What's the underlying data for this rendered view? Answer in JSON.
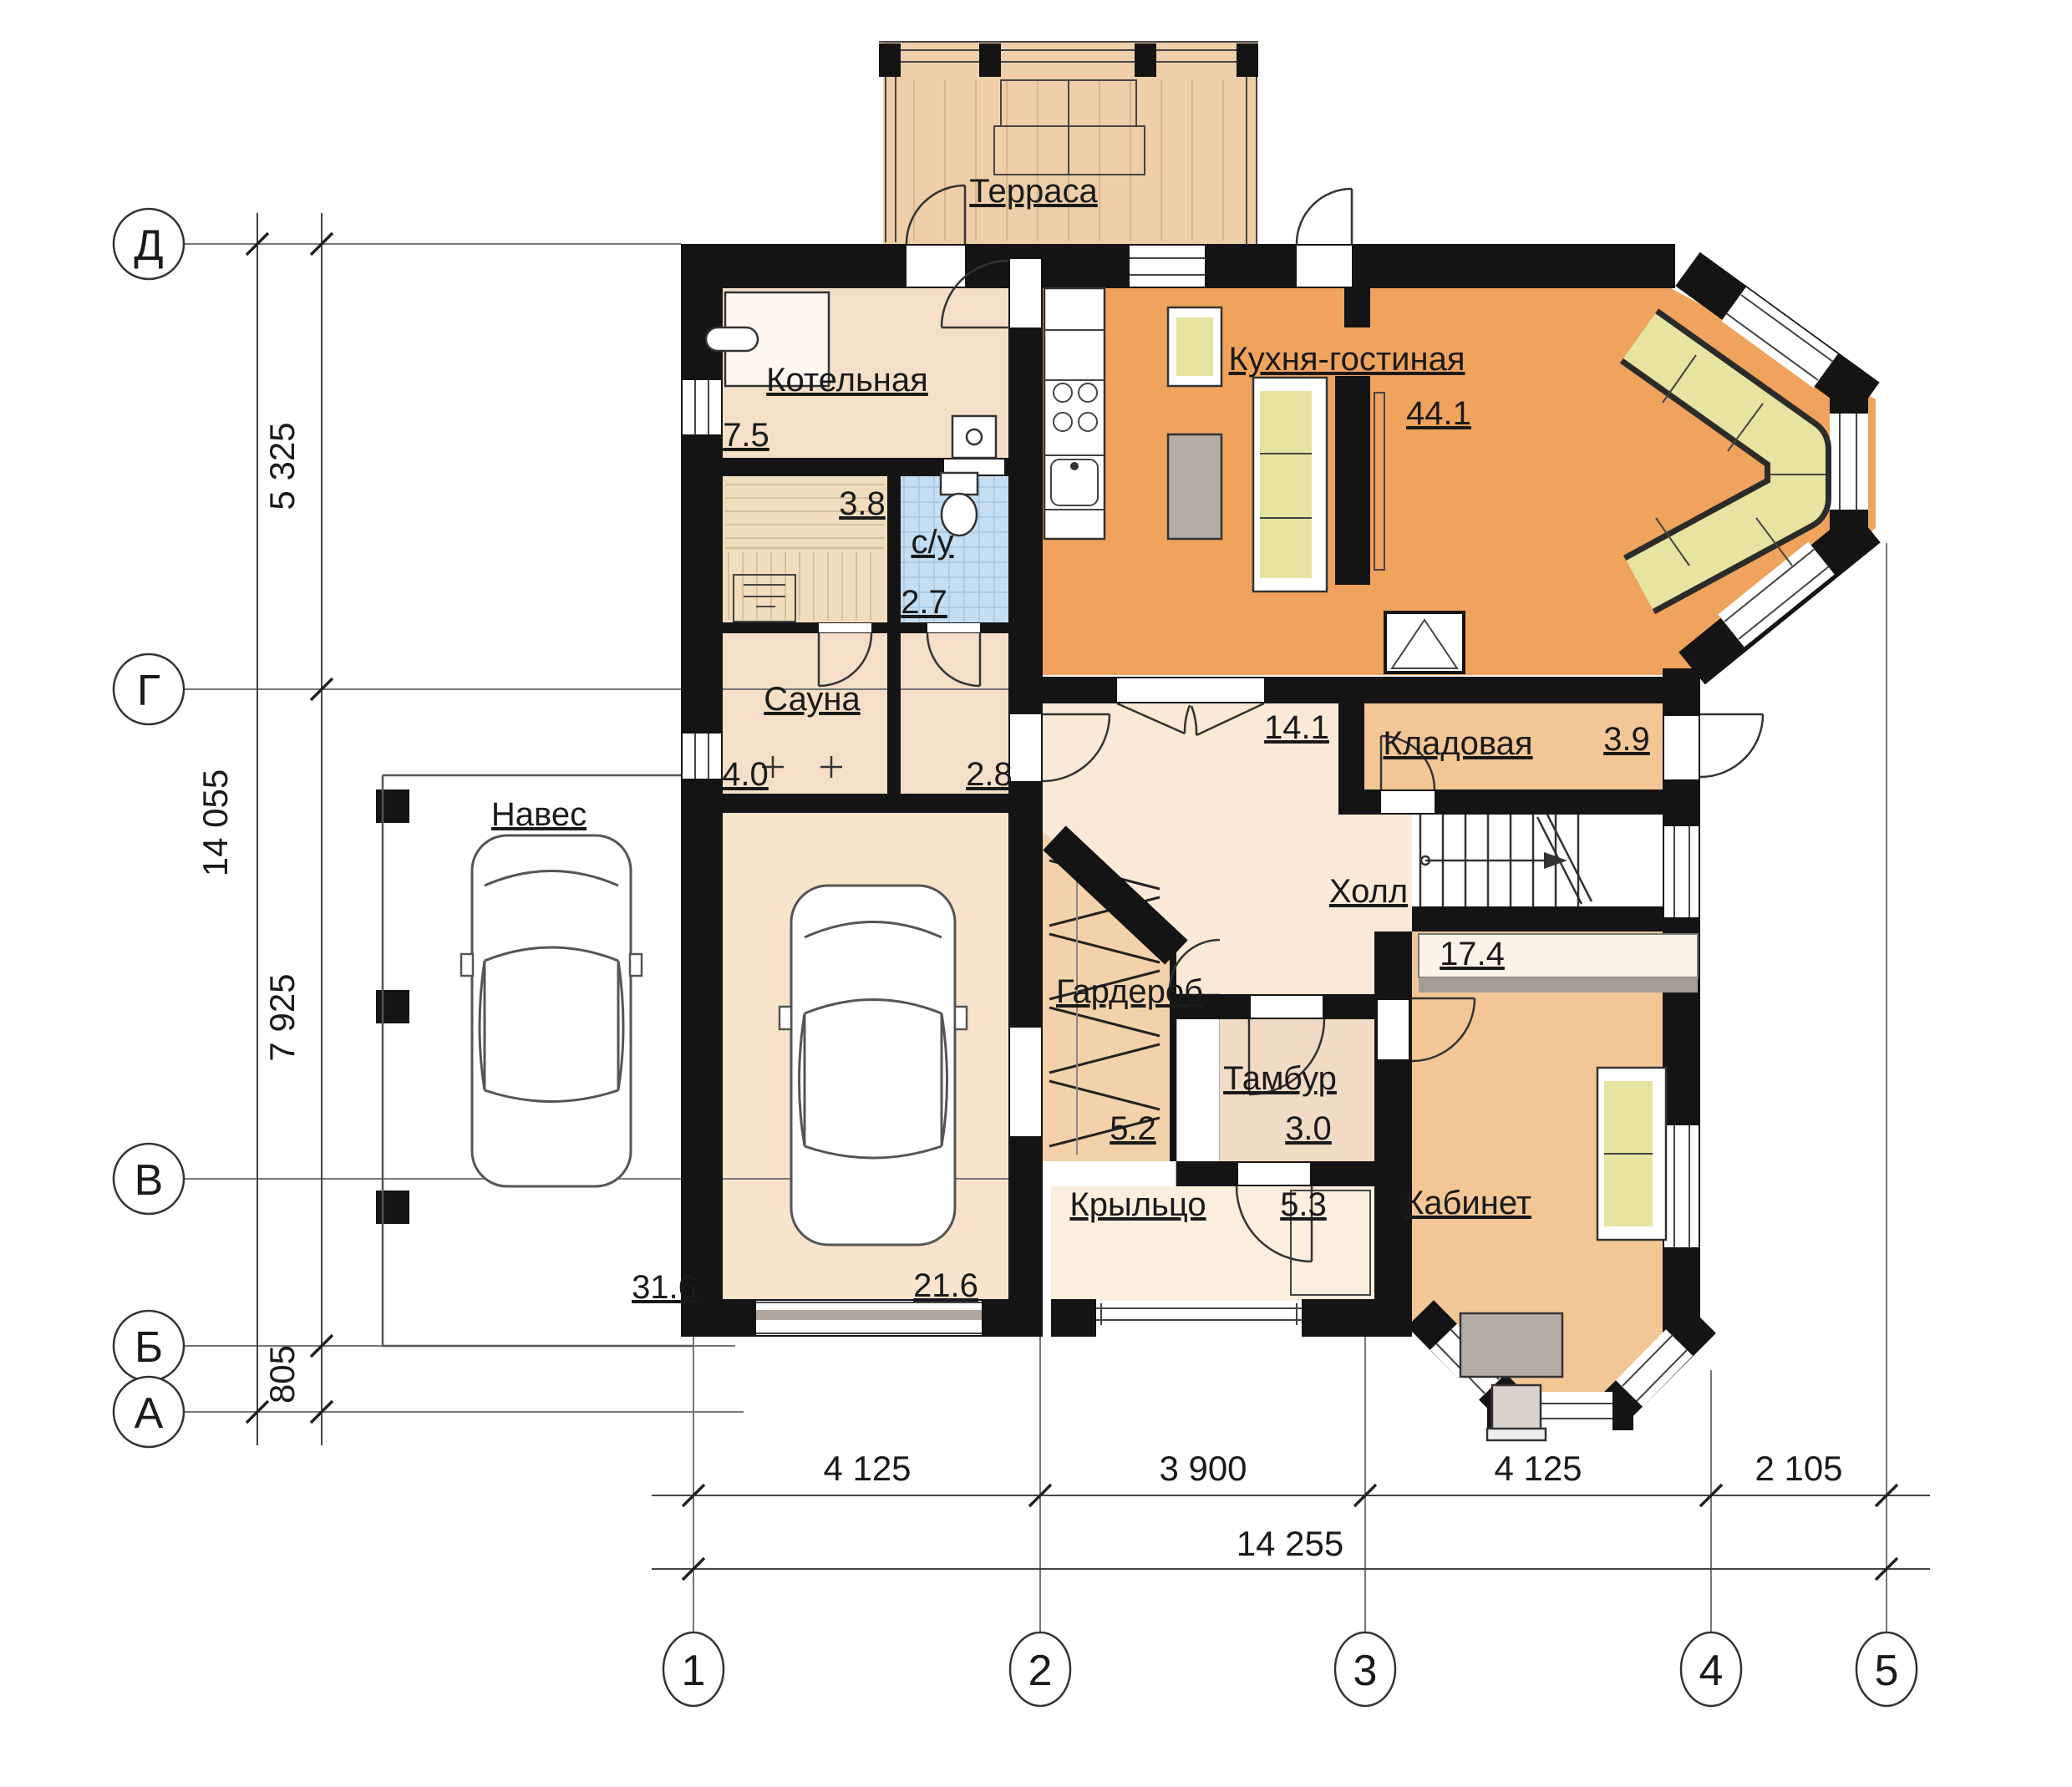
{
  "plan": {
    "rooms": {
      "terrace": {
        "name": "Терраса"
      },
      "boiler": {
        "name": "Котельная",
        "area": "7.5"
      },
      "sauna_cabin": {
        "area": "3.8"
      },
      "bathroom": {
        "name": "с/у",
        "area": "2.7"
      },
      "sauna": {
        "name": "Сауна",
        "area": "4.0"
      },
      "corridor": {
        "area": "2.8"
      },
      "kitchen_living": {
        "name": "Кухня-гостиная",
        "area": "44.1"
      },
      "pantry": {
        "name": "Кладовая",
        "area": "3.9"
      },
      "hall": {
        "name": "Холл",
        "area": "14.1"
      },
      "office": {
        "name": "Кабинет",
        "area": "17.4"
      },
      "wardrobe": {
        "name": "Гардероб",
        "area": "5.2"
      },
      "vestibule": {
        "name": "Тамбур",
        "area": "3.0"
      },
      "porch": {
        "name": "Крыльцо",
        "area": "5.3"
      },
      "garage": {
        "area": "21.6"
      },
      "carport": {
        "name": "Навес",
        "area": "31.6"
      }
    },
    "axes": {
      "rows": [
        "Д",
        "Г",
        "В",
        "Б",
        "А"
      ],
      "cols": [
        "1",
        "2",
        "3",
        "4",
        "5"
      ]
    },
    "dims": {
      "v_spans": [
        "5 325",
        "7 925",
        "805"
      ],
      "v_total": "14 055",
      "h_spans": [
        "4 125",
        "3 900",
        "4 125",
        "2 105"
      ],
      "h_total": "14 255"
    },
    "colors": {
      "wall": "#141414",
      "terrace_floor": "#eecfa9",
      "kitchen_floor": "#f0a35c",
      "room_beige": "#f5dfc8",
      "hall_floor": "#f9e9d6",
      "pantry_floor": "#f3c795",
      "office_floor": "#f3c795",
      "wardrobe_floor": "#f3d2ab",
      "vestibule_floor": "#f1dbc5",
      "porch_floor": "#fbeedd",
      "garage_floor": "#f8e3cb",
      "sauna_wood": "#f1ddbe",
      "bathroom_floor": "#c5def2",
      "sofa_yellow": "#e7e3a1",
      "furniture_gray": "#b5aca5"
    }
  }
}
